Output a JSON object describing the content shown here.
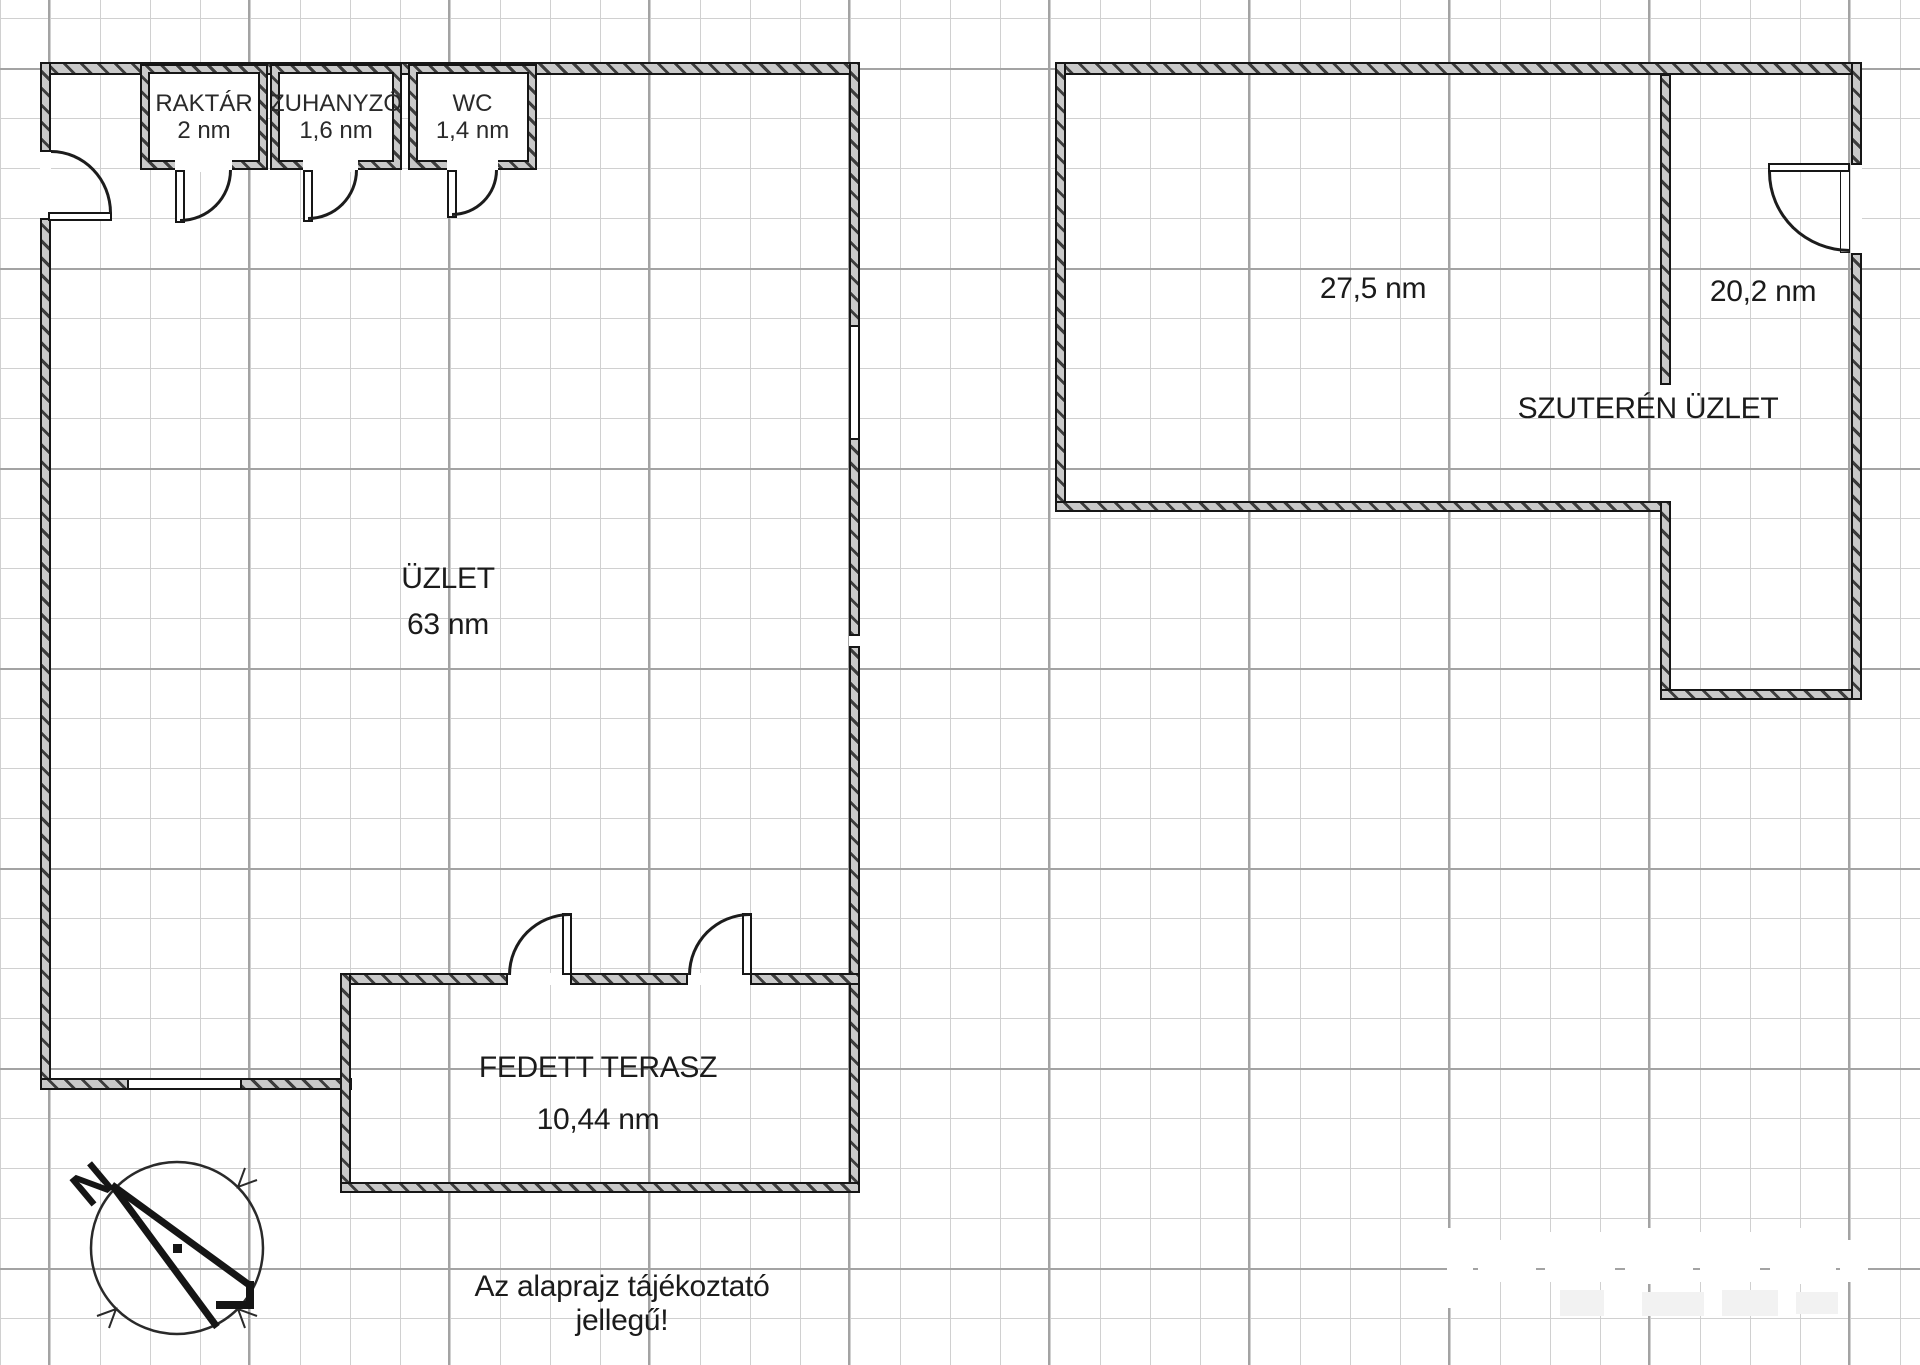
{
  "plan": {
    "title_note": "Az alaprajz tájékoztató jellegű!",
    "rooms": [
      {
        "id": "raktar",
        "name": "RAKTÁR",
        "area": "2 nm"
      },
      {
        "id": "zuhanyzo",
        "name": "ZUHANYZÓ",
        "area": "1,6 nm"
      },
      {
        "id": "wc",
        "name": "WC",
        "area": "1,4 nm"
      },
      {
        "id": "uzlet",
        "name": "ÜZLET",
        "area": "63 nm"
      },
      {
        "id": "fedett_terasz",
        "name": "FEDETT TERASZ",
        "area": "10,44 nm"
      },
      {
        "id": "szuteren_nagy",
        "name": "",
        "area": "27,5 nm"
      },
      {
        "id": "szuteren_kis",
        "name": "",
        "area": "20,2 nm"
      },
      {
        "id": "szuteren_uzlet",
        "name": "SZUTERÉN ÜZLET",
        "area": ""
      }
    ],
    "compass": {
      "label": "N"
    },
    "colors": {
      "background": "#ffffff",
      "wall_fill": "#c9c9c9",
      "wall_line": "#161616",
      "grid_minor": "#d0d0d0",
      "grid_major": "#a3a3a3",
      "text": "#1b1b1b"
    }
  }
}
